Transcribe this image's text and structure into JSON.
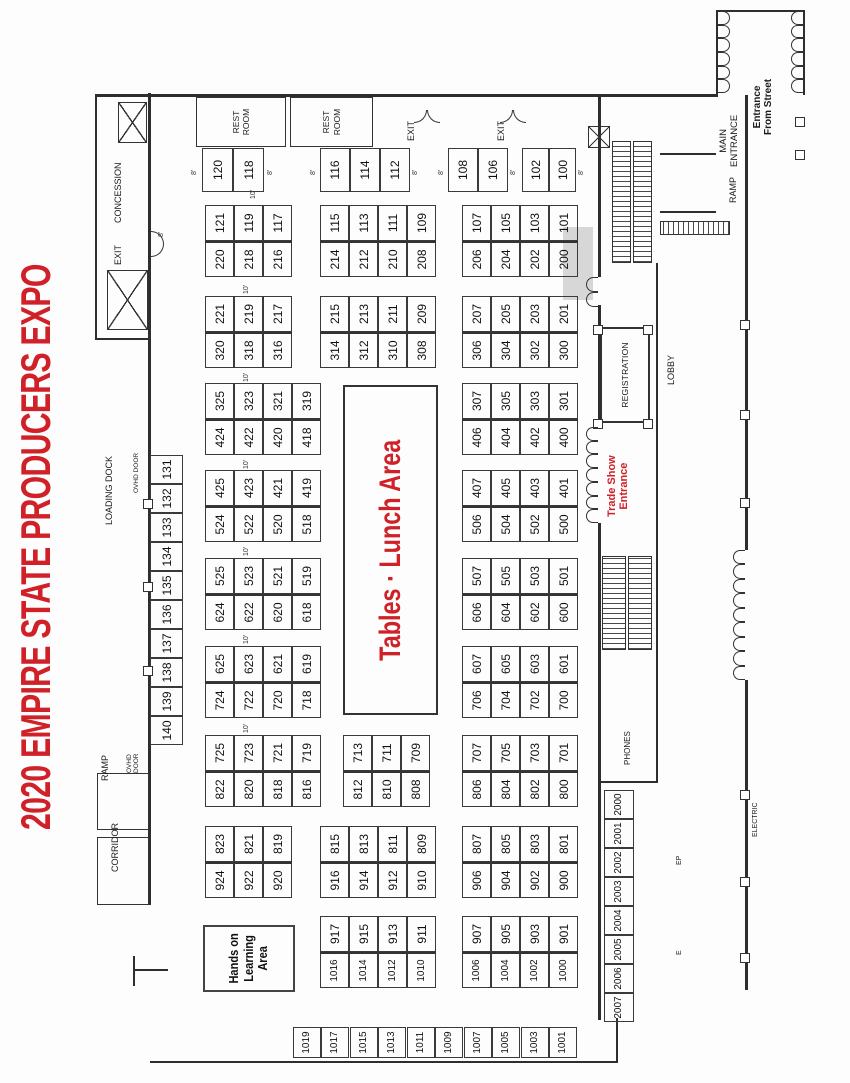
{
  "title": "2020 EMPIRE STATE PRODUCERS EXPO",
  "colors": {
    "red": "#d02028",
    "line": "#2e2e2e"
  },
  "lunch_area": {
    "label": "Tables · Lunch Area"
  },
  "hands_on_area": {
    "label": "Hands on\nLearning\nArea"
  },
  "rooms": {
    "rest_room_label": "REST\nROOM",
    "registration_label": "REGISTRATION"
  },
  "islands": [
    {
      "x": 806,
      "y": 205,
      "rows": [
        [
          "220",
          "121"
        ],
        [
          "218",
          "119"
        ],
        [
          "216",
          "117"
        ]
      ]
    },
    {
      "x": 806,
      "y": 320,
      "rows": [
        [
          "214",
          "115"
        ],
        [
          "212",
          "113"
        ],
        [
          "210",
          "111"
        ],
        [
          "208",
          "109"
        ]
      ]
    },
    {
      "x": 806,
      "y": 462,
      "rows": [
        [
          "206",
          "107"
        ],
        [
          "204",
          "105"
        ],
        [
          "202",
          "103"
        ],
        [
          "200",
          "101"
        ]
      ]
    },
    {
      "x": 715,
      "y": 205,
      "rows": [
        [
          "320",
          "221"
        ],
        [
          "318",
          "219"
        ],
        [
          "316",
          "217"
        ]
      ]
    },
    {
      "x": 715,
      "y": 320,
      "rows": [
        [
          "314",
          "215"
        ],
        [
          "312",
          "213"
        ],
        [
          "310",
          "211"
        ],
        [
          "308",
          "209"
        ]
      ]
    },
    {
      "x": 715,
      "y": 462,
      "rows": [
        [
          "306",
          "207"
        ],
        [
          "304",
          "205"
        ],
        [
          "302",
          "203"
        ],
        [
          "300",
          "201"
        ]
      ]
    },
    {
      "x": 628,
      "y": 205,
      "rows": [
        [
          "424",
          "325"
        ],
        [
          "422",
          "323"
        ],
        [
          "420",
          "321"
        ],
        [
          "418",
          "319"
        ]
      ]
    },
    {
      "x": 628,
      "y": 462,
      "rows": [
        [
          "406",
          "307"
        ],
        [
          "404",
          "305"
        ],
        [
          "402",
          "303"
        ],
        [
          "400",
          "301"
        ]
      ]
    },
    {
      "x": 541,
      "y": 205,
      "rows": [
        [
          "524",
          "425"
        ],
        [
          "522",
          "423"
        ],
        [
          "520",
          "421"
        ],
        [
          "518",
          "419"
        ]
      ]
    },
    {
      "x": 541,
      "y": 462,
      "rows": [
        [
          "506",
          "407"
        ],
        [
          "504",
          "405"
        ],
        [
          "502",
          "403"
        ],
        [
          "500",
          "401"
        ]
      ]
    },
    {
      "x": 453,
      "y": 205,
      "rows": [
        [
          "624",
          "525"
        ],
        [
          "622",
          "523"
        ],
        [
          "620",
          "521"
        ],
        [
          "618",
          "519"
        ]
      ]
    },
    {
      "x": 453,
      "y": 462,
      "rows": [
        [
          "606",
          "507"
        ],
        [
          "604",
          "505"
        ],
        [
          "602",
          "503"
        ],
        [
          "600",
          "501"
        ]
      ]
    },
    {
      "x": 365,
      "y": 205,
      "rows": [
        [
          "724",
          "625"
        ],
        [
          "722",
          "623"
        ],
        [
          "720",
          "621"
        ],
        [
          "718",
          "619"
        ]
      ]
    },
    {
      "x": 365,
      "y": 462,
      "rows": [
        [
          "706",
          "607"
        ],
        [
          "704",
          "605"
        ],
        [
          "702",
          "603"
        ],
        [
          "700",
          "601"
        ]
      ]
    },
    {
      "x": 276,
      "y": 205,
      "rows": [
        [
          "822",
          "725"
        ],
        [
          "820",
          "723"
        ],
        [
          "818",
          "721"
        ],
        [
          "816",
          "719"
        ]
      ]
    },
    {
      "x": 276,
      "y": 343,
      "rows": [
        [
          "812",
          "713"
        ],
        [
          "810",
          "711"
        ],
        [
          "808",
          "709"
        ]
      ]
    },
    {
      "x": 276,
      "y": 462,
      "rows": [
        [
          "806",
          "707"
        ],
        [
          "804",
          "705"
        ],
        [
          "802",
          "703"
        ],
        [
          "800",
          "701"
        ]
      ]
    },
    {
      "x": 185,
      "y": 205,
      "rows": [
        [
          "924",
          "823"
        ],
        [
          "922",
          "821"
        ],
        [
          "920",
          "819"
        ]
      ]
    },
    {
      "x": 185,
      "y": 320,
      "rows": [
        [
          "916",
          "815"
        ],
        [
          "914",
          "813"
        ],
        [
          "912",
          "811"
        ],
        [
          "910",
          "809"
        ]
      ]
    },
    {
      "x": 185,
      "y": 462,
      "rows": [
        [
          "906",
          "807"
        ],
        [
          "904",
          "805"
        ],
        [
          "902",
          "803"
        ],
        [
          "900",
          "801"
        ]
      ]
    },
    {
      "x": 95,
      "y": 320,
      "rows": [
        [
          "1016",
          "917"
        ],
        [
          "1014",
          "915"
        ],
        [
          "1012",
          "913"
        ],
        [
          "1010",
          "911"
        ]
      ]
    },
    {
      "x": 95,
      "y": 462,
      "rows": [
        [
          "1006",
          "907"
        ],
        [
          "1004",
          "905"
        ],
        [
          "1002",
          "903"
        ],
        [
          "1000",
          "901"
        ]
      ]
    }
  ],
  "island_cell": {
    "w": 36,
    "h": 29,
    "font": 12
  },
  "single_booths": [
    {
      "n": "120",
      "x": 891,
      "y": 202,
      "w": 44,
      "h": 31
    },
    {
      "n": "118",
      "x": 891,
      "y": 233,
      "w": 44,
      "h": 31
    },
    {
      "n": "116",
      "x": 891,
      "y": 320,
      "w": 44,
      "h": 30
    },
    {
      "n": "114",
      "x": 891,
      "y": 350,
      "w": 44,
      "h": 30
    },
    {
      "n": "112",
      "x": 891,
      "y": 380,
      "w": 44,
      "h": 30
    },
    {
      "n": "108",
      "x": 891,
      "y": 448,
      "w": 44,
      "h": 30
    },
    {
      "n": "106",
      "x": 891,
      "y": 478,
      "w": 44,
      "h": 30
    },
    {
      "n": "102",
      "x": 891,
      "y": 522,
      "w": 44,
      "h": 27
    },
    {
      "n": "100",
      "x": 891,
      "y": 549,
      "w": 44,
      "h": 27
    },
    {
      "n": "140",
      "x": 338,
      "y": 150,
      "w": 29,
      "h": 33
    },
    {
      "n": "139",
      "x": 367,
      "y": 150,
      "w": 29,
      "h": 33
    },
    {
      "n": "138",
      "x": 396,
      "y": 150,
      "w": 29,
      "h": 33
    },
    {
      "n": "137",
      "x": 425,
      "y": 150,
      "w": 29,
      "h": 33
    },
    {
      "n": "136",
      "x": 454,
      "y": 150,
      "w": 29,
      "h": 33
    },
    {
      "n": "135",
      "x": 483,
      "y": 150,
      "w": 29,
      "h": 33
    },
    {
      "n": "134",
      "x": 512,
      "y": 150,
      "w": 29,
      "h": 33
    },
    {
      "n": "133",
      "x": 541,
      "y": 150,
      "w": 29,
      "h": 33
    },
    {
      "n": "132",
      "x": 570,
      "y": 150,
      "w": 29,
      "h": 33
    },
    {
      "n": "131",
      "x": 599,
      "y": 150,
      "w": 29,
      "h": 33
    },
    {
      "n": "1019",
      "x": 25,
      "y": 293,
      "w": 31,
      "h": 28
    },
    {
      "n": "1017",
      "x": 25,
      "y": 321,
      "w": 31,
      "h": 28
    },
    {
      "n": "1015",
      "x": 25,
      "y": 350,
      "w": 31,
      "h": 28
    },
    {
      "n": "1013",
      "x": 25,
      "y": 378,
      "w": 31,
      "h": 28
    },
    {
      "n": "1011",
      "x": 25,
      "y": 407,
      "w": 31,
      "h": 28
    },
    {
      "n": "1009",
      "x": 25,
      "y": 435,
      "w": 31,
      "h": 28
    },
    {
      "n": "1007",
      "x": 25,
      "y": 464,
      "w": 31,
      "h": 28
    },
    {
      "n": "1005",
      "x": 25,
      "y": 492,
      "w": 31,
      "h": 28
    },
    {
      "n": "1003",
      "x": 25,
      "y": 521,
      "w": 31,
      "h": 28
    },
    {
      "n": "1001",
      "x": 25,
      "y": 549,
      "w": 31,
      "h": 28
    },
    {
      "n": "2007",
      "x": 61,
      "y": 604,
      "w": 29,
      "h": 30
    },
    {
      "n": "2006",
      "x": 90,
      "y": 604,
      "w": 29,
      "h": 30
    },
    {
      "n": "2005",
      "x": 119,
      "y": 604,
      "w": 29,
      "h": 30
    },
    {
      "n": "2004",
      "x": 148,
      "y": 604,
      "w": 29,
      "h": 30
    },
    {
      "n": "2003",
      "x": 177,
      "y": 604,
      "w": 29,
      "h": 30
    },
    {
      "n": "2002",
      "x": 206,
      "y": 604,
      "w": 29,
      "h": 30
    },
    {
      "n": "2001",
      "x": 235,
      "y": 604,
      "w": 29,
      "h": 30
    },
    {
      "n": "2000",
      "x": 264,
      "y": 604,
      "w": 29,
      "h": 30
    }
  ],
  "labels": [
    {
      "name": "concession-label",
      "t": "CONCESSION",
      "x": 860,
      "y": 113,
      "s": 9
    },
    {
      "name": "exit-top-label",
      "t": "EXIT",
      "x": 818,
      "y": 113,
      "s": 9
    },
    {
      "name": "loading-dock-label",
      "t": "LOADING DOCK",
      "x": 558,
      "y": 104,
      "s": 9
    },
    {
      "name": "ovhd-door-1-label",
      "t": "OVHD DOOR",
      "x": 590,
      "y": 133,
      "s": 6.5
    },
    {
      "name": "ramp-left-label",
      "t": "RAMP",
      "x": 302,
      "y": 100,
      "s": 9
    },
    {
      "name": "ovhd-door-2-label",
      "t": "OVHD\nDOOR",
      "x": 310,
      "y": 126,
      "s": 6.5
    },
    {
      "name": "corridor-label",
      "t": "CORRIDOR",
      "x": 211,
      "y": 110,
      "s": 9
    },
    {
      "name": "exit-right-1-label",
      "t": "EXIT",
      "x": 942,
      "y": 406,
      "s": 9
    },
    {
      "name": "exit-right-2-label",
      "t": "EXIT",
      "x": 942,
      "y": 496,
      "s": 9
    },
    {
      "name": "lobby-label",
      "t": "LOBBY",
      "x": 698,
      "y": 666,
      "s": 9
    },
    {
      "name": "phones-label",
      "t": "PHONES",
      "x": 318,
      "y": 624,
      "s": 8
    },
    {
      "name": "trade-show-entrance-label",
      "t": "Trade Show\nEntrance",
      "x": 566,
      "y": 606,
      "s": 11,
      "bold": true,
      "red": true,
      "center": true
    },
    {
      "name": "main-entrance-label",
      "t": "MAIN\nENTRANCE",
      "x": 916,
      "y": 719,
      "s": 9.5,
      "center": true
    },
    {
      "name": "entrance-from-street-label",
      "t": "Entrance\nFrom Street",
      "x": 948,
      "y": 752,
      "s": 10,
      "bold": true,
      "center": true
    },
    {
      "name": "ramp-right-label",
      "t": "RAMP",
      "x": 880,
      "y": 728,
      "s": 9
    },
    {
      "name": "electric-label",
      "t": "ELECTRIC",
      "x": 246,
      "y": 752,
      "s": 7
    },
    {
      "name": "ep-mark",
      "t": "EP",
      "x": 218,
      "y": 676,
      "s": 7
    },
    {
      "name": "e-mark",
      "t": "E",
      "x": 128,
      "y": 676,
      "s": 7
    }
  ],
  "dim_labels": [
    {
      "t": "8'",
      "x": 908,
      "y": 191
    },
    {
      "t": "8'",
      "x": 908,
      "y": 267
    },
    {
      "t": "8'",
      "x": 908,
      "y": 310
    },
    {
      "t": "8'",
      "x": 908,
      "y": 412
    },
    {
      "t": "8'",
      "x": 908,
      "y": 438
    },
    {
      "t": "8'",
      "x": 908,
      "y": 510
    },
    {
      "t": "8'",
      "x": 908,
      "y": 578
    },
    {
      "t": "8'",
      "x": 846,
      "y": 158
    },
    {
      "t": "10'",
      "x": 884,
      "y": 250
    },
    {
      "t": "10'",
      "x": 789,
      "y": 243
    },
    {
      "t": "10'",
      "x": 701,
      "y": 243
    },
    {
      "t": "10'",
      "x": 614,
      "y": 243
    },
    {
      "t": "10'",
      "x": 527,
      "y": 243
    },
    {
      "t": "10'",
      "x": 439,
      "y": 243
    },
    {
      "t": "10'",
      "x": 350,
      "y": 243
    }
  ],
  "walls": [
    [
      178,
      148,
      812,
      3
    ],
    [
      986,
      95,
      3,
      623
    ],
    [
      20,
      150,
      2,
      468
    ],
    [
      20,
      616,
      45,
      2
    ],
    [
      743,
      95,
      245,
      2
    ],
    [
      743,
      95,
      2,
      55
    ],
    [
      63,
      598,
      497,
      2.5
    ],
    [
      656,
      598,
      122,
      2.5
    ],
    [
      806,
      598,
      182,
      2.5
    ],
    [
      300,
      598,
      2,
      60
    ],
    [
      300,
      656,
      520,
      2
    ],
    [
      93,
      745,
      310,
      2.5
    ],
    [
      533,
      745,
      455,
      2.5
    ],
    [
      988,
      716,
      85,
      2
    ],
    [
      988,
      803,
      85,
      2
    ],
    [
      1071,
      716,
      2,
      89
    ],
    [
      870,
      660,
      2,
      56
    ],
    [
      928,
      660,
      2,
      56
    ],
    [
      97,
      133,
      30,
      1.5
    ],
    [
      112,
      133,
      1.5,
      35
    ]
  ],
  "outline_boxes": [
    [
      178,
      97,
      66,
      50
    ],
    [
      253,
      97,
      55,
      50
    ]
  ],
  "shaded": [
    [
      783,
      563,
      73,
      30
    ]
  ],
  "stairs": [
    [
      820,
      612,
      122,
      19
    ],
    [
      820,
      633,
      122,
      19
    ],
    [
      433,
      602,
      94,
      24
    ],
    [
      433,
      628,
      94,
      24
    ]
  ],
  "bridges": [
    [
      848,
      660,
      14,
      70
    ]
  ],
  "elevators": [
    [
      940,
      118,
      41,
      29
    ],
    [
      753,
      107,
      60,
      41
    ],
    [
      935,
      588,
      22,
      22
    ]
  ],
  "bumps": [
    [
      120,
      740
    ],
    [
      196,
      740
    ],
    [
      283,
      740
    ],
    [
      575,
      740
    ],
    [
      663,
      740
    ],
    [
      753,
      740
    ],
    [
      407,
      143
    ],
    [
      491,
      143
    ],
    [
      574,
      143
    ],
    [
      654,
      593
    ],
    [
      748,
      593
    ],
    [
      654,
      643
    ],
    [
      748,
      643
    ],
    [
      923,
      795
    ],
    [
      956,
      795
    ]
  ],
  "scallops": [
    {
      "x": 560,
      "y": 586,
      "w": 96,
      "n": 7,
      "dir": "up"
    },
    {
      "x": 776,
      "y": 586,
      "w": 30,
      "n": 2,
      "dir": "up"
    },
    {
      "x": 403,
      "y": 733,
      "w": 130,
      "n": 9,
      "dir": "up"
    },
    {
      "x": 990,
      "y": 718,
      "w": 82,
      "n": 6,
      "dir": "down"
    },
    {
      "x": 990,
      "y": 791,
      "w": 82,
      "n": 6,
      "dir": "up"
    }
  ],
  "door_pairs": [
    {
      "x": 960,
      "y": 414,
      "dir": "left"
    },
    {
      "x": 960,
      "y": 500,
      "dir": "left"
    },
    {
      "x": 826,
      "y": 151,
      "dir": "down"
    }
  ]
}
